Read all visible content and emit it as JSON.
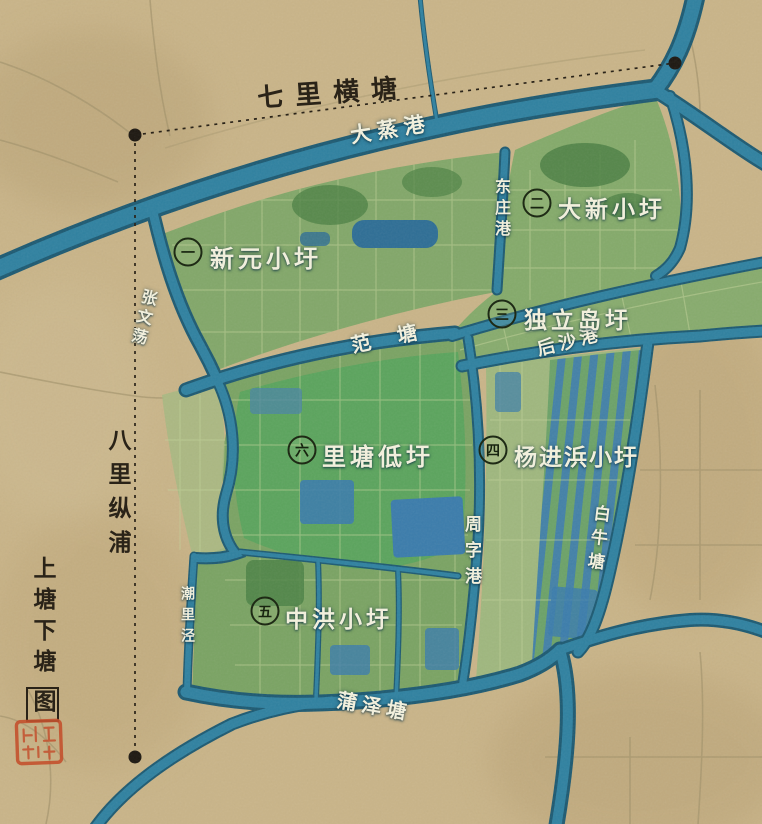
{
  "map_title": {
    "main": "上塘下塘",
    "boxed_char": "图"
  },
  "boundary_labels": {
    "north": "七里横塘",
    "west": "八里纵浦"
  },
  "river_labels": {
    "dazhenggang": "大蒸港",
    "dongzhuanggang": "东庄港",
    "zhangwendang": "张文荡",
    "fantang": "范 塘",
    "houshagang": "后沙港",
    "zhouzigang": "周字港",
    "bainiutang": "白牛塘",
    "chaolijing": "潮里泾",
    "puzetang": "蒲泽塘"
  },
  "polder_labels": {
    "one": {
      "num": "一",
      "name": "新元小圩"
    },
    "two": {
      "num": "二",
      "name": "大新小圩"
    },
    "three": {
      "num": "三",
      "name": "独立岛圩"
    },
    "four": {
      "num": "四",
      "name": "杨进浜小圩"
    },
    "five": {
      "num": "五",
      "name": "中洪小圩"
    },
    "six": {
      "num": "六",
      "name": "里塘低圩"
    }
  },
  "icons": {
    "seal": "red-seal-stamp"
  },
  "colors": {
    "parchment": "#c9b488",
    "river_dark": "#1d5a72",
    "river_light": "#2f81a0",
    "polder_green": "#7fa766",
    "bright_green": "#58a45c",
    "paddy_blue": "#3b7cab",
    "ink": "#2a2318",
    "label_white": "#f1efdc",
    "seal_red": "#c3512e"
  }
}
